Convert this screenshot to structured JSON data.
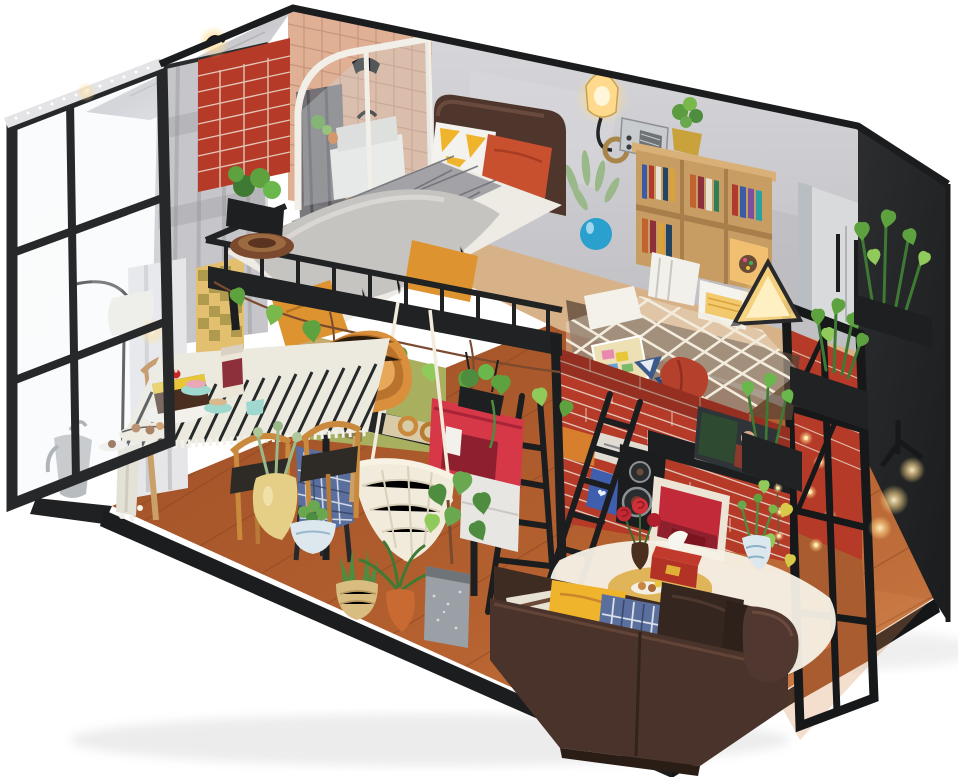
{
  "meta": {
    "type": "product-photo",
    "subject": "DIY miniature dollhouse kit — two-level loft apartment diorama with LED lights",
    "description": "Isometric open-box miniature loft: upper level with bathroom, bedroom loft bed, bookshelf wall and net hammock nook; ground level with dining set, desk, hanging chair, leather sofa and many potted plants, on a black base against a white background."
  },
  "palette": {
    "background": "#ffffff",
    "base_black": "#1b1d1f",
    "floor_wood": "#b4602f",
    "floor_light": "#cd7f48",
    "seam_brown": "#8a4423",
    "wall_concrete": "#c9c9cd",
    "wall_black": "#232527",
    "brick_red": "#b53a28",
    "mortar_cream": "#e9ddcf",
    "tile_pink": "#e0b095",
    "grout": "#c08f76",
    "curtain_silver": "#c6c6ca",
    "curtain_white": "#e6e6e9",
    "glass_tint": "rgba(236,241,246,0.30)",
    "frame_black": "#26282a",
    "foil_silver": "#d7d7db",
    "shower_white": "#f2efe8",
    "duvet_white": "#edebe4",
    "fur_gray": "#c6c4c1",
    "plaid_gray": "#a3a3a7",
    "blanket_orange": "#dd9330",
    "headboard_brown": "#4e362c",
    "pillow_yellow": "#f0b42c",
    "pillow_red": "#c8502f",
    "glow_warm": "#ffd98c",
    "bookshelf_wood": "#c79d63",
    "wardrobe_gray": "#d8dadc",
    "net_cream": "#f1ebdc",
    "cushion_red": "#b5402c",
    "sofa_brown": "#4a332a",
    "sofa_dark": "#39271f",
    "table_wood": "#d8a94c",
    "rug_cream": "#f5f1e6",
    "tissue_red": "#b23226",
    "machine_red": "#d63848",
    "desk_black": "#232527",
    "chair_wood": "#c98a3e",
    "wicker_orange": "#d98f3c",
    "teal": "#9fd8cf",
    "cake_choco": "#4a2f20",
    "cake_yellow": "#e8c63a",
    "plant_green": "#5da23f",
    "plant_light": "#8fca5a",
    "pot_terracotta": "#c96a33",
    "vase_blue": "#2aa0cf",
    "porcelain": "#dce8ee",
    "plaid_blue": "#5a6f9e",
    "tablecloth": "#eceadf",
    "green_wall": "#a8b060",
    "slat_door": "#c9a86a",
    "picture_red": "#c22a3a",
    "poster_dark": "#2e3438",
    "loft_tan": "#d7b289"
  },
  "scene": {
    "objects": [
      "glass-door-wall with LED strip",
      "silver foil roof wedge",
      "gray checkered curtain",
      "arc floor lamp",
      "red brick column",
      "bathroom with curved shower enclosure and pink tiles",
      "concrete bedroom wall",
      "loft bed with fur throw and duvet",
      "leather headboard",
      "triangle pillow",
      "orange pillow",
      "wall sconce lamp",
      "vintage radio",
      "bookshelf with books",
      "plant in blue vase",
      "gray wardrobe",
      "glowing triangle lamp",
      "net hammock nook with map, origami boats and magnifier",
      "red slipper cushion",
      "red brick living wall with posters and child photo",
      "black speaker",
      "red framed picture",
      "string lights",
      "black ladders",
      "green hallway wall with slatted door",
      "dining table with striped runner, chocolate cake, teal cake stands and jar",
      "wooden hoop chairs",
      "orange wicker chair",
      "desk with laptop and pretzel tray",
      "red coffee machine",
      "hanging crochet chair",
      "stool with blue plaid blanket",
      "potted plants",
      "brown leather sofa with pillows",
      "round coffee table with tissue box and remote",
      "red roses in vase",
      "blue porcelain vase",
      "white sheepskin rug",
      "black window frame with brick behind",
      "balcony planter boxes",
      "black display base"
    ]
  }
}
